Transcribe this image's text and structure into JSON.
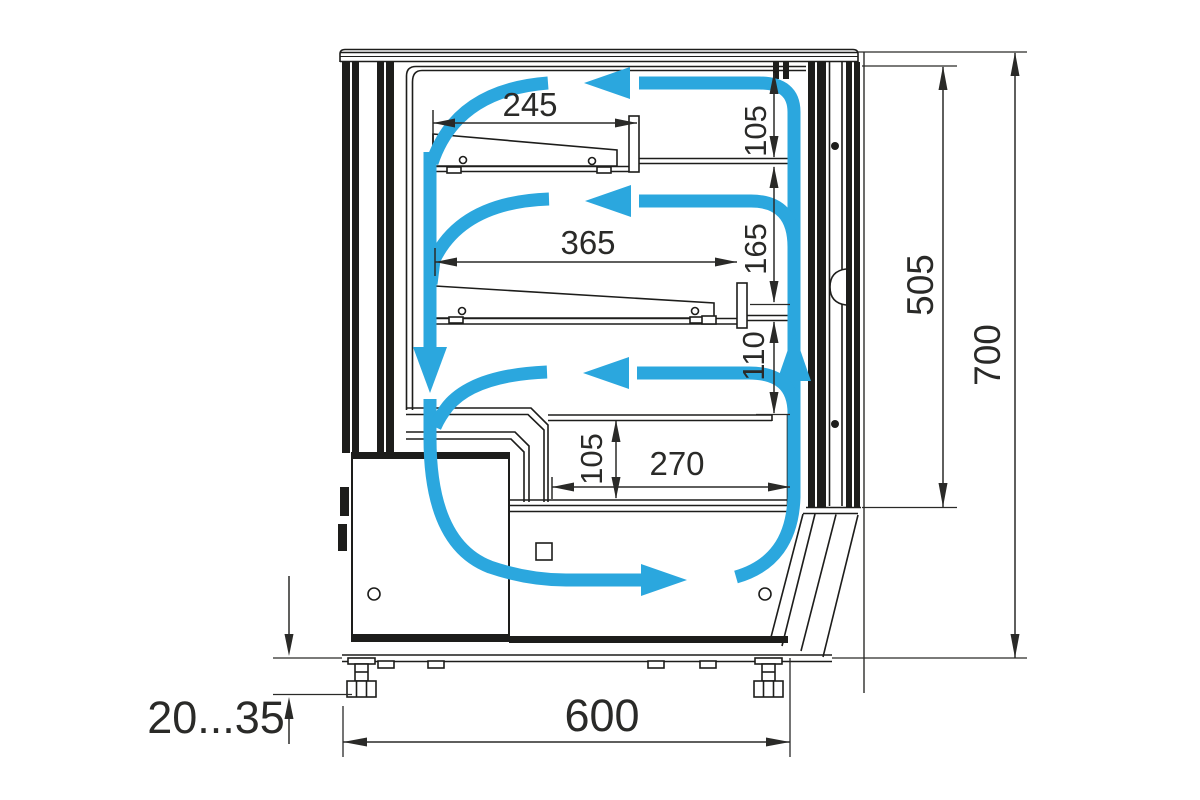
{
  "drawing": {
    "kind": "refrigerated-display-case-cross-section",
    "units": "mm"
  },
  "labels": {
    "shelf_upper_depth": "245",
    "shelf_lower_depth": "365",
    "clearance_top": "105",
    "clearance_middle": "165",
    "air_inlet_height": "110",
    "well_height": "105",
    "well_depth": "270",
    "glass_height": "505",
    "overall_height": "700",
    "overall_depth": "600",
    "foot_adjust_range": "20...35"
  },
  "colors": {
    "airflow_blue": "#2BA7DE",
    "line_black": "#1D1D1B",
    "background": "#FFFFFF"
  }
}
